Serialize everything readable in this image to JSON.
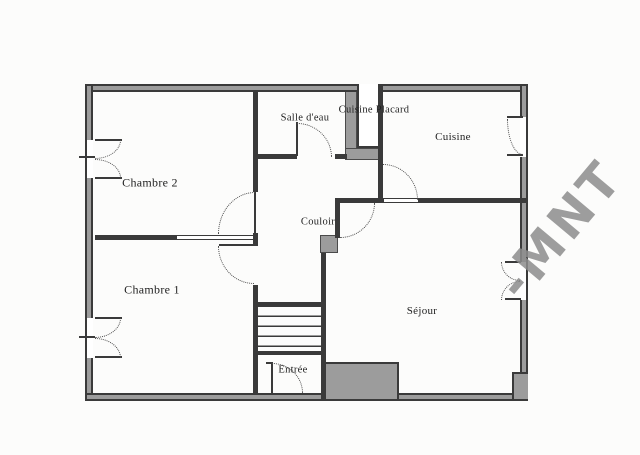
{
  "plan": {
    "rooms": [
      {
        "name": "chambre-2",
        "label": "Chambre 2"
      },
      {
        "name": "chambre-1",
        "label": "Chambre 1"
      },
      {
        "name": "salle-deau",
        "label": "Salle d'eau"
      },
      {
        "name": "cuisine-placard",
        "label": "Cuisine Placard"
      },
      {
        "name": "cuisine",
        "label": "Cuisine"
      },
      {
        "name": "couloir",
        "label": "Couloir"
      },
      {
        "name": "sejour",
        "label": "Séjour"
      },
      {
        "name": "entree",
        "label": "Entrée"
      }
    ],
    "colors": {
      "wall_line": "#3a3a3a",
      "wall_fill": "#9c9c9c",
      "background": "#fcfcfb",
      "watermark": "#8d8d8d",
      "label_text": "#1f1f1f"
    }
  },
  "watermark": {
    "text": "-MNT"
  }
}
